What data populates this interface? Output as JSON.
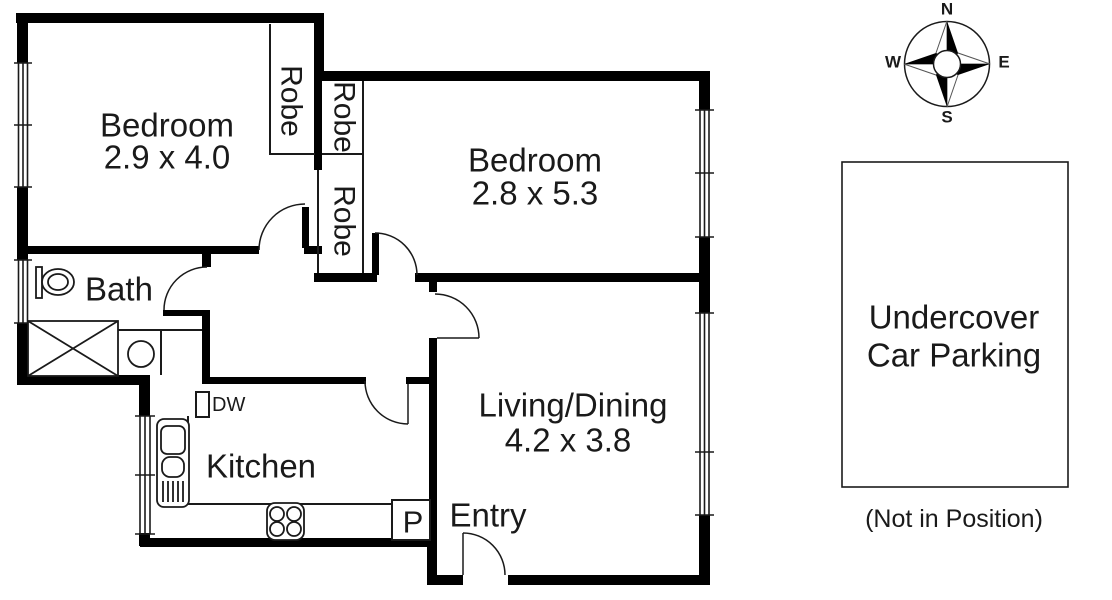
{
  "rooms": {
    "bedroom1": {
      "name": "Bedroom",
      "dims": "2.9 x 4.0"
    },
    "bedroom2": {
      "name": "Bedroom",
      "dims": "2.8 x 5.3"
    },
    "living": {
      "name": "Living/Dining",
      "dims": "4.2 x 3.8"
    },
    "bath": {
      "name": "Bath"
    },
    "kitchen": {
      "name": "Kitchen"
    },
    "entry": {
      "name": "Entry"
    }
  },
  "closets": {
    "robe1": "Robe",
    "robe2": "Robe",
    "robe3": "Robe"
  },
  "fixtures": {
    "dishwasher": "DW",
    "pantry": "P"
  },
  "compass": {
    "n": "N",
    "e": "E",
    "s": "S",
    "w": "W"
  },
  "parking": {
    "title_line1": "Undercover",
    "title_line2": "Car Parking",
    "note": "(Not in Position)"
  },
  "colors": {
    "wall": "#000000",
    "line": "#1a1a1a",
    "background": "#ffffff"
  }
}
